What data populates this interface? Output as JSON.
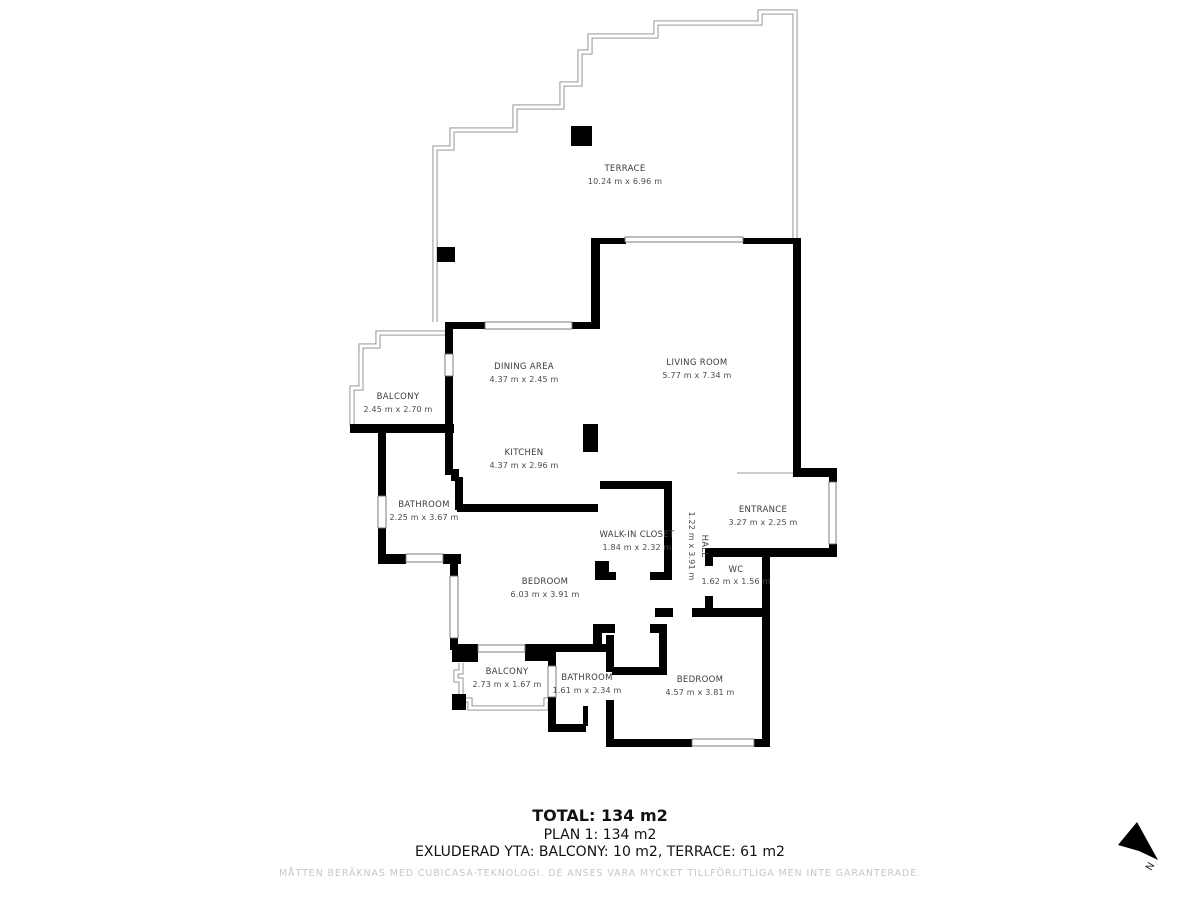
{
  "floorplan": {
    "rooms": [
      {
        "name": "TERRACE",
        "dims": "10.24 m x 6.96 m"
      },
      {
        "name": "LIVING ROOM",
        "dims": "5.77 m x 7.34 m"
      },
      {
        "name": "DINING AREA",
        "dims": "4.37 m x 2.45 m"
      },
      {
        "name": "BALCONY",
        "dims": "2.45 m x 2.70 m"
      },
      {
        "name": "KITCHEN",
        "dims": "4.37 m x 2.96 m"
      },
      {
        "name": "BATHROOM",
        "dims": "2.25 m x 3.67 m"
      },
      {
        "name": "WALK-IN CLOSET",
        "dims": "1.84 m x 2.32 m"
      },
      {
        "name": "HALL",
        "dims": "1.22 m x 3.91 m"
      },
      {
        "name": "ENTRANCE",
        "dims": "3.27 m x 2.25 m"
      },
      {
        "name": "WC",
        "dims": "1.62 m x 1.56 m"
      },
      {
        "name": "BEDROOM",
        "dims": "6.03 m x 3.91 m"
      },
      {
        "name": "BALCONY",
        "dims": "2.73 m x 1.67 m"
      },
      {
        "name": "BATHROOM",
        "dims": "1.61 m x 2.34 m"
      },
      {
        "name": "BEDROOM",
        "dims": "4.57 m x 3.81 m"
      }
    ],
    "summary": {
      "total": "TOTAL: 134 m2",
      "plan": "PLAN 1: 134 m2",
      "excluded": "EXLUDERAD YTA: BALCONY: 10 m2, TERRACE: 61 m2"
    },
    "disclaimer": "MÅTTEN BERÄKNAS MED CUBICASA-TEKNOLOGI. DE ANSES VARA MYCKET TILLFÖRLITLIGA MEN INTE GARANTERADE.",
    "compass": {
      "label": "N"
    },
    "colors": {
      "wall": "#000000",
      "outline": "#8a8a8a",
      "label": "#3b3b3b",
      "disclaimer": "#c7c7c7"
    }
  }
}
